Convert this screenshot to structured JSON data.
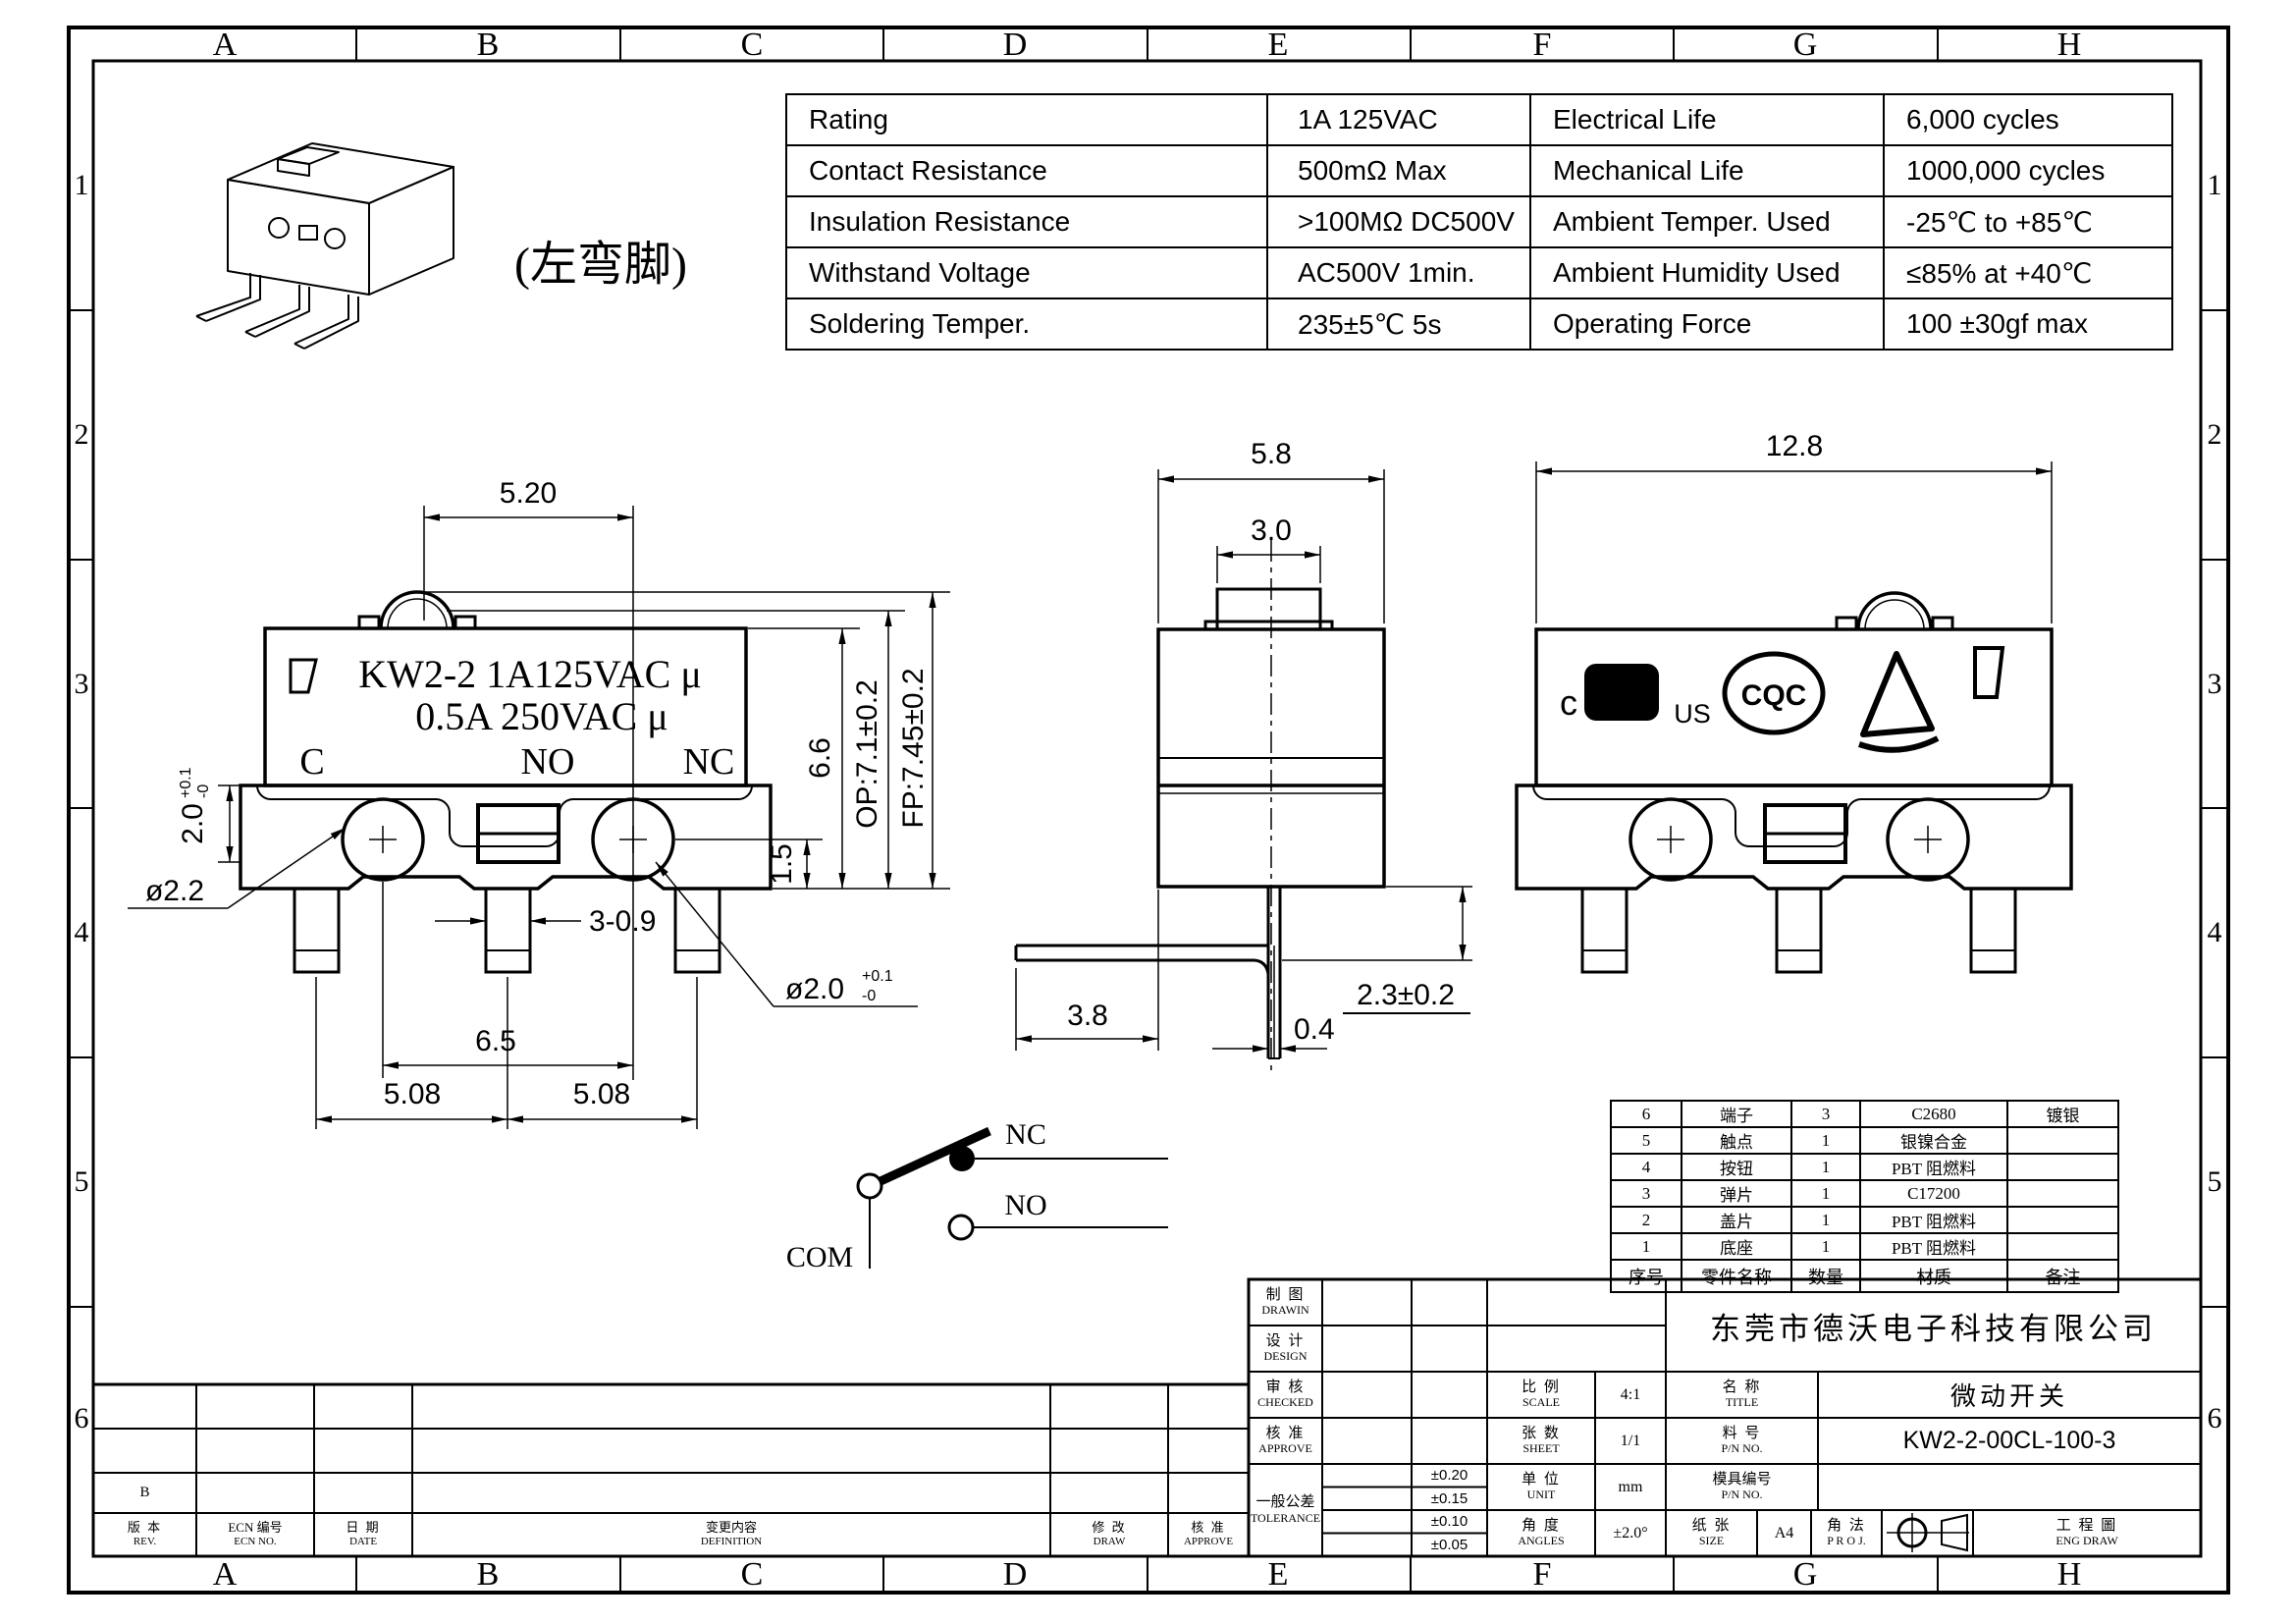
{
  "zones": {
    "letters": [
      "A",
      "B",
      "C",
      "D",
      "E",
      "F",
      "G",
      "H"
    ],
    "numbers": [
      "1",
      "2",
      "3",
      "4",
      "5",
      "6"
    ]
  },
  "spec_table": {
    "rows": [
      {
        "label1": "Rating",
        "value1": "1A  125VAC",
        "label2": "Electrical Life",
        "value2": "6,000 cycles"
      },
      {
        "label1": "Contact Resistance",
        "value1": "500mΩ  Max",
        "label2": "Mechanical Life",
        "value2": "1000,000 cycles"
      },
      {
        "label1": "Insulation Resistance",
        "value1": ">100MΩ DC500V",
        "label2": "Ambient Temper. Used",
        "value2": "-25℃ to +85℃"
      },
      {
        "label1": "Withstand Voltage",
        "value1": "AC500V  1min.",
        "label2": "Ambient Humidity Used",
        "value2": "≤85% at +40℃"
      },
      {
        "label1": "Soldering Temper.",
        "value1": "235±5℃ 5s",
        "label2": "Operating Force",
        "value2": "100 ±30gf max"
      }
    ]
  },
  "iso": {
    "label": "(左弯脚)"
  },
  "front_view": {
    "marking1": "KW2-2 1A125VAC μ",
    "marking2": "0.5A 250VAC μ",
    "term_c": "C",
    "term_no": "NO",
    "term_nc": "NC",
    "dims": {
      "d520": "5.20",
      "d20": "2.0",
      "d20_tol_u": "+0.1",
      "d20_tol_d": "-0",
      "dia22": "ø2.2",
      "d309": "3-0.9",
      "d65": "6.5",
      "d508a": "5.08",
      "d508b": "5.08",
      "dia20": "ø2.0",
      "dia20_tol_u": "+0.1",
      "dia20_tol_d": "-0",
      "d15": "1.5",
      "d66": "6.6",
      "dop": "OP:7.1±0.2",
      "dfp": "FP:7.45±0.2"
    }
  },
  "side_view": {
    "dims": {
      "d58": "5.8",
      "d30": "3.0",
      "d38": "3.8",
      "d04": "0.4",
      "d23": "2.3±0.2"
    }
  },
  "right_view": {
    "dim128": "12.8",
    "cert_c": "c",
    "cert_ul": "UL",
    "cert_us": "US",
    "cert_cqc": "CQC"
  },
  "circuit": {
    "nc": "NC",
    "no": "NO",
    "com": "COM"
  },
  "bom": {
    "headers": [
      "序号",
      "零件名称",
      "数量",
      "材质",
      "备注"
    ],
    "rows": [
      {
        "no": "6",
        "name": "端子",
        "qty": "3",
        "material": "C2680",
        "note": "镀银"
      },
      {
        "no": "5",
        "name": "触点",
        "qty": "1",
        "material": "银镍合金",
        "note": ""
      },
      {
        "no": "4",
        "name": "按钮",
        "qty": "1",
        "material": "PBT  阻燃料",
        "note": ""
      },
      {
        "no": "3",
        "name": "弹片",
        "qty": "1",
        "material": "C17200",
        "note": ""
      },
      {
        "no": "2",
        "name": "盖片",
        "qty": "1",
        "material": "PBT  阻燃料",
        "note": ""
      },
      {
        "no": "1",
        "name": "底座",
        "qty": "1",
        "material": "PBT  阻燃料",
        "note": ""
      }
    ]
  },
  "title_block": {
    "company": "东莞市德沃电子科技有限公司",
    "drawing": {
      "cn": "制 图",
      "en": "DRAWIN"
    },
    "design": {
      "cn": "设 计",
      "en": "DESIGN"
    },
    "checked": {
      "cn": "审 核",
      "en": "CHECKED"
    },
    "approve": {
      "cn": "核 准",
      "en": "APPROVE"
    },
    "tolerance": {
      "cn": "一般公差",
      "en": "TOLERANCE"
    },
    "tol_values": [
      "±0.20",
      "±0.15",
      "±0.10",
      "±0.05"
    ],
    "scale": {
      "cn": "比 例",
      "en": "SCALE",
      "value": "4:1"
    },
    "sheet": {
      "cn": "张 数",
      "en": "SHEET",
      "value": "1/1"
    },
    "unit": {
      "cn": "单 位",
      "en": "UNIT",
      "value": "mm"
    },
    "angles": {
      "cn": "角 度",
      "en": "ANGLES",
      "value": "±2.0°"
    },
    "title": {
      "cn": "名 称",
      "en": "TITLE",
      "value": "微动开关"
    },
    "part_no": {
      "cn": "料 号",
      "en": "P/N NO.",
      "value": "KW2-2-00CL-100-3"
    },
    "mold_no": {
      "cn": "模具编号",
      "en": "P/N NO.",
      "value": ""
    },
    "paper": {
      "cn": "纸 张",
      "en": "SIZE",
      "value": "A4"
    },
    "projection": {
      "cn": "角 法",
      "en": "P R O J."
    },
    "eng_draw": {
      "cn": "工 程 圖",
      "en": "ENG DRAW"
    }
  },
  "revision": {
    "rev_mark": "B",
    "headers": {
      "rev": {
        "cn": "版 本",
        "en": "REV."
      },
      "ecn": {
        "cn": "ECN 编号",
        "en": "ECN NO."
      },
      "date": {
        "cn": "日 期",
        "en": "DATE"
      },
      "definition": {
        "cn": "变更内容",
        "en": "DEFINITION"
      },
      "draw": {
        "cn": "修 改",
        "en": "DRAW"
      },
      "approve": {
        "cn": "核 准",
        "en": "APPROVE"
      }
    }
  }
}
